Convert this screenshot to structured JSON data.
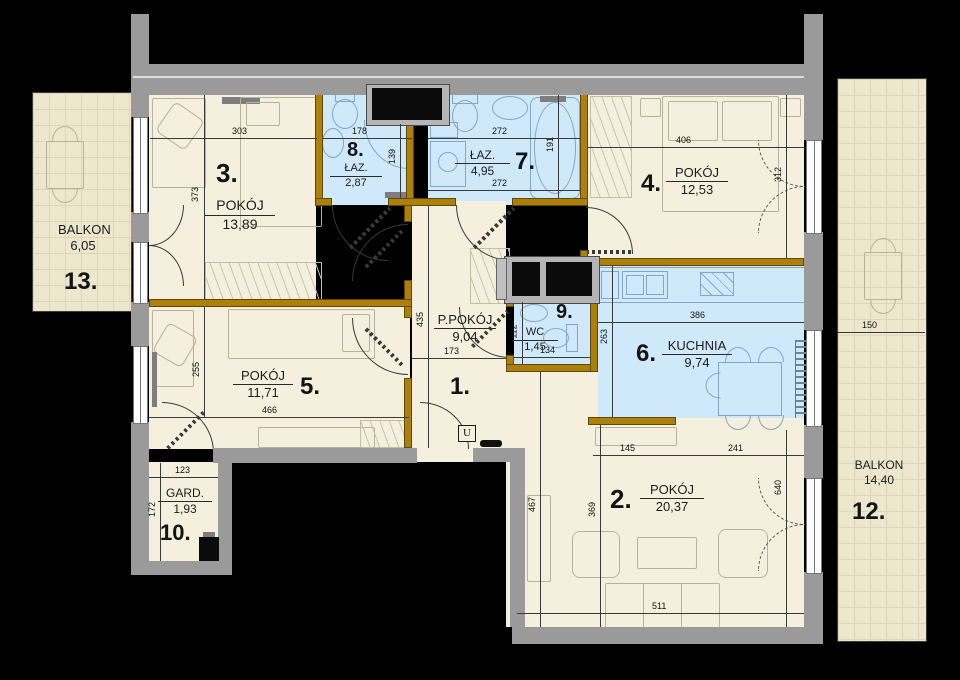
{
  "rooms": {
    "r1": {
      "number": "1.",
      "name": "P.POKÓJ",
      "area": "9,04"
    },
    "r2": {
      "number": "2.",
      "name": "POKÓJ",
      "area": "20,37"
    },
    "r3": {
      "number": "3.",
      "name": "POKÓJ",
      "area": "13,89"
    },
    "r4": {
      "number": "4.",
      "name": "POKÓJ",
      "area": "12,53"
    },
    "r5": {
      "number": "5.",
      "name": "POKÓJ",
      "area": "11,71"
    },
    "r6": {
      "number": "6.",
      "name": "KUCHNIA",
      "area": "9,74"
    },
    "r7": {
      "number": "7.",
      "name": "ŁAZ.",
      "area": "4,95"
    },
    "r8": {
      "number": "8.",
      "name": "ŁAZ.",
      "area": "2,87"
    },
    "r9": {
      "number": "9.",
      "name": "WC",
      "area": "1,45"
    },
    "r10": {
      "number": "10.",
      "name": "GARD.",
      "area": "1,93"
    },
    "r12": {
      "number": "12.",
      "name": "BALKON",
      "area": "14,40"
    },
    "r13": {
      "number": "13.",
      "name": "BALKON",
      "area": "6,05"
    }
  },
  "dims": {
    "d303": "303",
    "d373": "373",
    "d178": "178",
    "d139": "139",
    "d272a": "272",
    "d272b": "272",
    "d191": "191",
    "d406": "406",
    "d312": "312",
    "d435": "435",
    "d173": "173",
    "d112": "112",
    "d134": "134",
    "d386": "386",
    "d263": "263",
    "d255": "255",
    "d466": "466",
    "d123": "123",
    "d172": "172",
    "d145": "145",
    "d241": "241",
    "d467": "467",
    "d369": "369",
    "d640": "640",
    "d511": "511",
    "d150": "150"
  },
  "symbols": {
    "entrance": "U"
  },
  "colors": {
    "background": "#000000",
    "wall_exterior": "#9a9a9a",
    "wall_interior": "#ad800e",
    "floor_room": "#f5f0dd",
    "floor_wet": "#cfe9fb",
    "balcony_tile": "#ece7cd"
  }
}
